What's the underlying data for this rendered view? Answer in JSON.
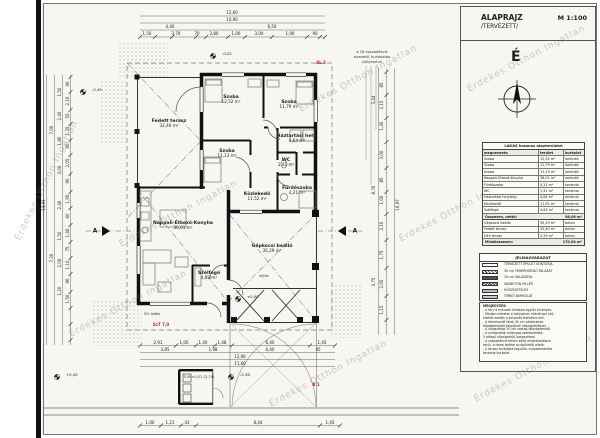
{
  "title_block": {
    "title": "ALAPRAJZ",
    "scale": "M 1:100",
    "subtitle": "/TERVEZETT/"
  },
  "north": {
    "letter": "É"
  },
  "symbols": {
    "level_marker": "⊕"
  },
  "watermark": {
    "text": "Érdekes Otthon Ingatlan"
  },
  "schedule": {
    "title": "LAKÁS hasznos alapterületei",
    "columns": [
      "megnevezés",
      "terület",
      "burkolat"
    ],
    "rows": [
      [
        "Szoba",
        "12,52 m²",
        "laminált"
      ],
      [
        "Szoba",
        "11,79 m²",
        "laminált"
      ],
      [
        "Szoba",
        "11,13 m²",
        "laminált"
      ],
      [
        "Nappali-Étkező-Konyha",
        "36,01 m²",
        "laminált"
      ],
      [
        "Fürdőszoba",
        "4,21 m²",
        "kerámia"
      ],
      [
        "WC",
        "1,41 m²",
        "kerámia"
      ],
      [
        "Háztartási helyiség",
        "4,64 m²",
        "kerámia"
      ],
      [
        "Közlekedő",
        "11,52 m²",
        "kerámia"
      ],
      [
        "Szélfogó",
        "4,83 m²",
        "kerámia"
      ]
    ],
    "subtotal_label": "Összesen, nettó:",
    "subtotal_value": "98,06 m²",
    "extra_rows": [
      [
        "Gépkocsi beálló",
        "35,29 m²",
        "beton"
      ],
      [
        "Fedett terasz",
        "32,40 m²",
        "beton"
      ],
      [
        "Déli terasz",
        "4,29 m²",
        "beton"
      ]
    ],
    "total_label": "Mindösszesen:",
    "total_value": "170,04 m²"
  },
  "legend": {
    "title": "JELMAGYARÁZAT",
    "items": [
      {
        "swatch": "plain",
        "label": "TERVEZETT ÉPÜLET KONTÚRJA"
      },
      {
        "swatch": "hatch",
        "label": "30 cm TEHERHORDÓ FALAZAT"
      },
      {
        "swatch": "dark",
        "label": "10 cm VÁLASZFAL"
      },
      {
        "swatch": "cross",
        "label": "VASBETON PILLÉR"
      },
      {
        "swatch": "gray",
        "label": "HŐSZIGETELÉS"
      },
      {
        "swatch": "dots",
        "label": "TÉRKŐ BURKOLAT"
      }
    ]
  },
  "notes": {
    "lines": [
      "MEGJEGYZÉS:",
      "- A terv a műszaki leírással együtt érvényes.",
      "- Minden méretet a helyszínen ellenőrizni kell,",
      "  eltérés esetén a tervezőt értesíteni kell.",
      "- A teherhordó falak 30 cm vázkerámia",
      "  falazóelemből készülnek hőszigeteléssel.",
      "- A válaszfalak 10 cm vastag falazóelemből.",
      "- A nyílászárók műanyag szerkezetűek,",
      "  3 rétegű hőszigetelő üvegezéssel.",
      "- A csapadékvíz telken belül elszikkasztásra",
      "  kerül, a terep lejtése az épülettől elfelé.",
      "- A terasz burkolata fagyálló, csúszásmentes",
      "  kerámia burkolat."
    ]
  },
  "rooms": [
    {
      "name": "Fedett terasz",
      "area": "32,40 m²",
      "x": 169,
      "y": 124
    },
    {
      "name": "Szoba",
      "area": "12,52 m²",
      "x": 231,
      "y": 100
    },
    {
      "name": "Szoba",
      "area": "11,79 m²",
      "x": 289,
      "y": 105
    },
    {
      "name": "Szoba",
      "area": "11,13 m²",
      "x": 227,
      "y": 154
    },
    {
      "name": "Háztartási hely.",
      "area": "4,64 m²",
      "x": 297,
      "y": 139
    },
    {
      "name": "WC",
      "area": "1,41 m²",
      "x": 286,
      "y": 163
    },
    {
      "name": "Fürdőszoba",
      "area": "4,21 m²",
      "x": 297,
      "y": 191
    },
    {
      "name": "Közlekedő",
      "area": "11,52 m²",
      "x": 257,
      "y": 197
    },
    {
      "name": "Nappali-Étkező-Konyha",
      "area": "36,01 m²",
      "x": 183,
      "y": 226
    },
    {
      "name": "Szélfogó",
      "area": "4,83 m²",
      "x": 209,
      "y": 276
    },
    {
      "name": "Gépkocsi beálló",
      "area": "35,29 m²",
      "x": 272,
      "y": 249
    }
  ],
  "dims": [
    {
      "t": "12,60",
      "x": 232,
      "y": 13
    },
    {
      "t": "10,90",
      "x": 232,
      "y": 20
    },
    {
      "t": "4,40",
      "x": 170,
      "y": 27
    },
    {
      "t": "6,50",
      "x": 272,
      "y": 27
    },
    {
      "t": "1,50",
      "x": 147,
      "y": 34
    },
    {
      "t": "3,70",
      "x": 176,
      "y": 34
    },
    {
      "t": "70",
      "x": 197,
      "y": 34
    },
    {
      "t": "2,80",
      "x": 214,
      "y": 34
    },
    {
      "t": "1,00",
      "x": 236,
      "y": 34
    },
    {
      "t": "3,00",
      "x": 259,
      "y": 34
    },
    {
      "t": "1,90",
      "x": 290,
      "y": 34
    },
    {
      "t": "90",
      "x": 315,
      "y": 34
    },
    {
      "t": "14,91",
      "x": 44,
      "y": 205,
      "r": 1
    },
    {
      "t": "7,00",
      "x": 52,
      "y": 130,
      "r": 1
    },
    {
      "t": "7,20",
      "x": 52,
      "y": 258,
      "r": 1
    },
    {
      "t": "1,50",
      "x": 60,
      "y": 92,
      "r": 1
    },
    {
      "t": "2,40",
      "x": 60,
      "y": 116,
      "r": 1
    },
    {
      "t": "1,80",
      "x": 60,
      "y": 141,
      "r": 1
    },
    {
      "t": "3,00",
      "x": 60,
      "y": 170,
      "r": 1
    },
    {
      "t": "2,40",
      "x": 60,
      "y": 205,
      "r": 1
    },
    {
      "t": "1,50",
      "x": 60,
      "y": 236,
      "r": 1
    },
    {
      "t": "2,00",
      "x": 60,
      "y": 263,
      "r": 1
    },
    {
      "t": "1,20",
      "x": 60,
      "y": 291,
      "r": 1
    },
    {
      "t": "90",
      "x": 68,
      "y": 84,
      "r": 1
    },
    {
      "t": "2,10",
      "x": 68,
      "y": 101,
      "r": 1
    },
    {
      "t": "55",
      "x": 68,
      "y": 116,
      "r": 1
    },
    {
      "t": "1,35",
      "x": 68,
      "y": 131,
      "r": 1
    },
    {
      "t": "60",
      "x": 68,
      "y": 146,
      "r": 1
    },
    {
      "t": "2,05",
      "x": 68,
      "y": 163,
      "r": 1
    },
    {
      "t": "90",
      "x": 68,
      "y": 181,
      "r": 1
    },
    {
      "t": "1,95",
      "x": 68,
      "y": 199,
      "r": 1
    },
    {
      "t": "60",
      "x": 68,
      "y": 216,
      "r": 1
    },
    {
      "t": "1,40",
      "x": 68,
      "y": 233,
      "r": 1
    },
    {
      "t": "75",
      "x": 68,
      "y": 249,
      "r": 1
    },
    {
      "t": "1,10",
      "x": 68,
      "y": 265,
      "r": 1
    },
    {
      "t": "90",
      "x": 68,
      "y": 281,
      "r": 1
    },
    {
      "t": "1,50",
      "x": 68,
      "y": 299,
      "r": 1
    },
    {
      "t": "16,97",
      "x": 398,
      "y": 205,
      "r": 1
    },
    {
      "t": "3,44",
      "x": 374,
      "y": 100,
      "r": 1
    },
    {
      "t": "8,76",
      "x": 374,
      "y": 190,
      "r": 1
    },
    {
      "t": "3,75",
      "x": 374,
      "y": 282,
      "r": 1
    },
    {
      "t": "85",
      "x": 382,
      "y": 85,
      "r": 1
    },
    {
      "t": "2,15",
      "x": 382,
      "y": 105,
      "r": 1
    },
    {
      "t": "1,40",
      "x": 382,
      "y": 126,
      "r": 1
    },
    {
      "t": "3,00",
      "x": 382,
      "y": 155,
      "r": 1
    },
    {
      "t": "85",
      "x": 382,
      "y": 180,
      "r": 1
    },
    {
      "t": "1,00",
      "x": 382,
      "y": 200,
      "r": 1
    },
    {
      "t": "2,10",
      "x": 382,
      "y": 226,
      "r": 1
    },
    {
      "t": "1,75",
      "x": 382,
      "y": 255,
      "r": 1
    },
    {
      "t": "2,00",
      "x": 382,
      "y": 284,
      "r": 1
    },
    {
      "t": "1,15",
      "x": 382,
      "y": 310,
      "r": 1
    },
    {
      "t": "2,91",
      "x": 158,
      "y": 343
    },
    {
      "t": "1,00",
      "x": 184,
      "y": 343
    },
    {
      "t": "1,40",
      "x": 203,
      "y": 343
    },
    {
      "t": "1,48",
      "x": 222,
      "y": 343
    },
    {
      "t": "6,40",
      "x": 270,
      "y": 343
    },
    {
      "t": "1,45",
      "x": 322,
      "y": 343
    },
    {
      "t": "3,85",
      "x": 165,
      "y": 350
    },
    {
      "t": "1,98",
      "x": 213,
      "y": 350
    },
    {
      "t": "6,40",
      "x": 270,
      "y": 350
    },
    {
      "t": "45",
      "x": 318,
      "y": 350
    },
    {
      "t": "12,06",
      "x": 240,
      "y": 357
    },
    {
      "t": "11,60",
      "x": 240,
      "y": 364
    },
    {
      "t": "1,00",
      "x": 150,
      "y": 423
    },
    {
      "t": "1,21",
      "x": 170,
      "y": 423
    },
    {
      "t": "43",
      "x": 187,
      "y": 423
    },
    {
      "t": "8,44",
      "x": 258,
      "y": 423
    },
    {
      "t": "1,45",
      "x": 330,
      "y": 423
    }
  ],
  "annotations": [
    {
      "t": "⌀ 16 csapadékvíz",
      "x": 372,
      "y": 52,
      "c": "note"
    },
    {
      "t": "elvezető, burkolatba",
      "x": 372,
      "y": 57,
      "c": "note"
    },
    {
      "t": "süllyesztve",
      "x": 372,
      "y": 62,
      "c": "note"
    },
    {
      "t": "5% lejtés",
      "x": 152,
      "y": 314,
      "c": "note"
    },
    {
      "t": "lejtés",
      "x": 264,
      "y": 276,
      "c": "note"
    },
    {
      "t": "3,50±0,02 (2,74)",
      "x": 199,
      "y": 377,
      "c": "note"
    },
    {
      "t": "SzT 7,0",
      "x": 161,
      "y": 325,
      "c": "red"
    },
    {
      "t": "AL 2",
      "x": 321,
      "y": 63,
      "c": "red"
    },
    {
      "t": "B 1",
      "x": 316,
      "y": 385,
      "c": "red"
    },
    {
      "t": "A",
      "x": 95,
      "y": 231,
      "c": "sec"
    },
    {
      "t": "A",
      "x": 355,
      "y": 231,
      "c": "sec"
    }
  ],
  "levels": [
    {
      "t": "-0,02",
      "x": 222,
      "y": 54
    },
    {
      "t": "-0,45",
      "x": 92,
      "y": 90
    },
    {
      "t": "+0,45",
      "x": 66,
      "y": 375
    },
    {
      "t": "-0,36",
      "x": 240,
      "y": 375
    },
    {
      "t": "±0,00",
      "x": 247,
      "y": 297
    }
  ]
}
